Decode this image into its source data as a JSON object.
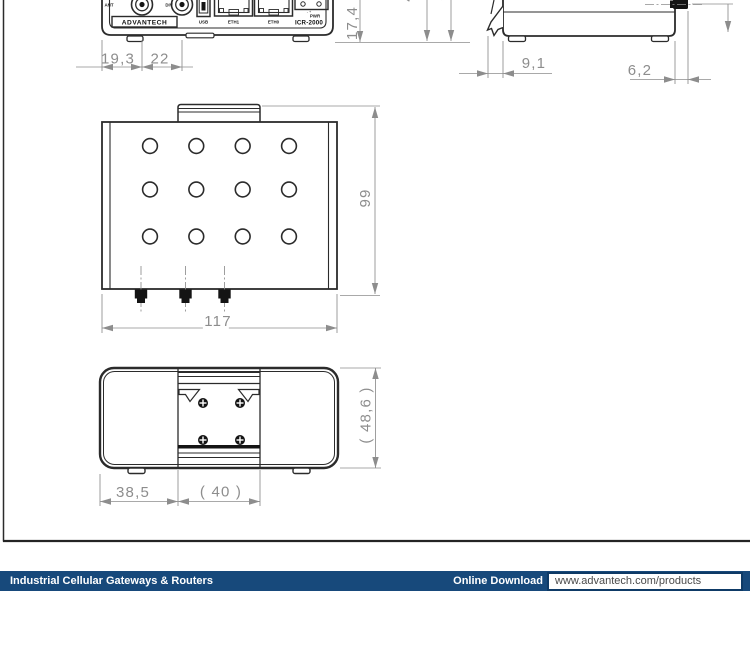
{
  "front_view": {
    "labels": {
      "ant": "ANT",
      "div": "DIV",
      "logo": "ADVANTECH",
      "usb": "USB",
      "eth1": "ETH1",
      "eth0": "ETH0",
      "pwr": "PWR",
      "polarity": "- +",
      "model": "ICR-2000"
    },
    "dims": {
      "w1": "19,3",
      "w2": "22",
      "h": "17,4",
      "partial_left": "4",
      "partial_right": "5"
    }
  },
  "side_view": {
    "dims": {
      "clip": "9,1",
      "knob": "6,2"
    }
  },
  "top_view": {
    "dims": {
      "width": "117",
      "height": "99"
    }
  },
  "bottom_view": {
    "dims": {
      "left": "38,5",
      "center": "( 40 )",
      "height": "( 48,6 )"
    }
  },
  "footer": {
    "title": "Industrial Cellular Gateways & Routers",
    "download_label": "Online Download",
    "url": "www.advantech.com/products"
  },
  "colors": {
    "outline": "#2b2b2b",
    "dimension": "#8d8d8d",
    "footer_bg": "#17497b",
    "footer_text": "#ffffff",
    "url_text": "#4a4a4a"
  }
}
